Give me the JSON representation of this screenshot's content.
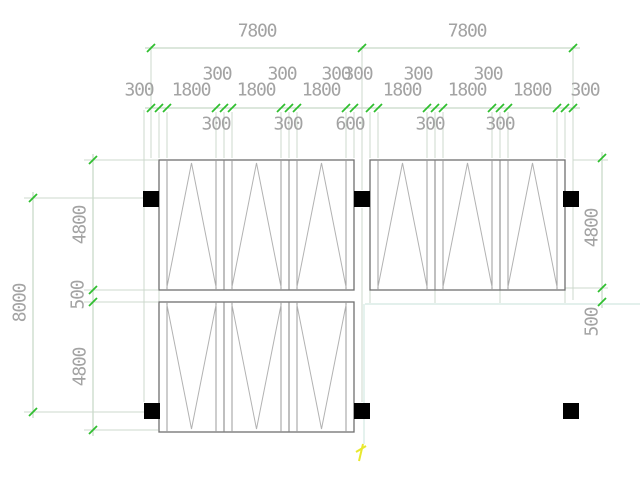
{
  "canvas": {
    "width": 640,
    "height": 480,
    "background": "#ffffff"
  },
  "palette": {
    "dim_line": "#b9cfb9",
    "ext_line": "#ccd8cc",
    "tick": "#2fbf2f",
    "text": "#a3a3a3",
    "outline": "#6f6f6f",
    "edge": "#7f7f7f",
    "panel": "#9b9b9b",
    "triangle": "#b2b2b2",
    "column": "#000000",
    "teal": "#daece6",
    "yellow": "#e8e82e"
  },
  "dimension_values": {
    "top_spans": [
      "7800",
      "7800"
    ],
    "chain_segments": [
      "300",
      "300",
      "1800",
      "300",
      "300",
      "1800",
      "300",
      "300",
      "1800",
      "300",
      "600",
      "300",
      "1800",
      "300",
      "300",
      "1800",
      "300",
      "300",
      "1800",
      "300",
      "300"
    ],
    "left_column": [
      "4800",
      "500",
      "4800",
      "8000"
    ],
    "right_column": [
      "4800",
      "500"
    ]
  },
  "texts": [
    {
      "n": "dim-7800-left",
      "v": "7800",
      "x": 257,
      "y": 31
    },
    {
      "n": "dim-7800-right",
      "v": "7800",
      "x": 467,
      "y": 31
    },
    {
      "n": "dim-300-rowA",
      "v": "300",
      "x": 217,
      "y": 74
    },
    {
      "n": "dim-300-rowA",
      "v": "300",
      "x": 282,
      "y": 74
    },
    {
      "n": "dim-300-rowA",
      "v": "300",
      "x": 336,
      "y": 74
    },
    {
      "n": "dim-300-rowA",
      "v": "300",
      "x": 358,
      "y": 74
    },
    {
      "n": "dim-300-rowA",
      "v": "300",
      "x": 418,
      "y": 74
    },
    {
      "n": "dim-300-rowA",
      "v": "300",
      "x": 488,
      "y": 74
    },
    {
      "n": "dim-300-rowB",
      "v": "300",
      "x": 139,
      "y": 90
    },
    {
      "n": "dim-1800",
      "v": "1800",
      "x": 191,
      "y": 90
    },
    {
      "n": "dim-1800",
      "v": "1800",
      "x": 256,
      "y": 90
    },
    {
      "n": "dim-1800",
      "v": "1800",
      "x": 321,
      "y": 90
    },
    {
      "n": "dim-1800",
      "v": "1800",
      "x": 402,
      "y": 90
    },
    {
      "n": "dim-1800",
      "v": "1800",
      "x": 467,
      "y": 90
    },
    {
      "n": "dim-1800",
      "v": "1800",
      "x": 532,
      "y": 90
    },
    {
      "n": "dim-300-rowB",
      "v": "300",
      "x": 585,
      "y": 90
    },
    {
      "n": "dim-300-rowC",
      "v": "300",
      "x": 216,
      "y": 124
    },
    {
      "n": "dim-300-rowC",
      "v": "300",
      "x": 288,
      "y": 124
    },
    {
      "n": "dim-600-rowC",
      "v": "600",
      "x": 350,
      "y": 124
    },
    {
      "n": "dim-300-rowC",
      "v": "300",
      "x": 430,
      "y": 124
    },
    {
      "n": "dim-300-rowC",
      "v": "300",
      "x": 500,
      "y": 124
    },
    {
      "n": "dim-4800-left-top",
      "v": "4800",
      "x": 80,
      "y": 225,
      "r": -90
    },
    {
      "n": "dim-500-left",
      "v": "500",
      "x": 78,
      "y": 295,
      "r": -90
    },
    {
      "n": "dim-4800-left-bottom",
      "v": "4800",
      "x": 80,
      "y": 367,
      "r": -90
    },
    {
      "n": "dim-8000-left",
      "v": "8000",
      "x": 20,
      "y": 303,
      "r": -90
    },
    {
      "n": "dim-4800-right",
      "v": "4800",
      "x": 592,
      "y": 228,
      "r": -90
    },
    {
      "n": "dim-500-right",
      "v": "500",
      "x": 592,
      "y": 322,
      "r": -90
    }
  ],
  "chain_x": [
    151,
    159,
    167,
    216,
    224,
    232,
    281,
    289,
    297,
    346,
    354,
    370,
    378,
    427,
    435,
    443,
    492,
    500,
    508,
    557,
    565,
    573
  ],
  "lines": {
    "dim_line": [
      [
        145,
        48,
        580,
        48
      ],
      [
        145,
        108,
        580,
        108
      ],
      [
        33,
        192,
        33,
        418
      ],
      [
        93,
        154,
        93,
        436
      ],
      [
        602,
        152,
        602,
        308
      ]
    ],
    "ext_line": [
      [
        24,
        198,
        143,
        198
      ],
      [
        24,
        412,
        144,
        412
      ],
      [
        84,
        160,
        158,
        160
      ],
      [
        84,
        290,
        158,
        290
      ],
      [
        84,
        302,
        158,
        302
      ],
      [
        84,
        430,
        158,
        430
      ],
      [
        573,
        160,
        608,
        160
      ],
      [
        565,
        288,
        608,
        288
      ],
      [
        151,
        46,
        151,
        158
      ],
      [
        362,
        46,
        362,
        190
      ],
      [
        362,
        208,
        362,
        402
      ],
      [
        573,
        46,
        573,
        300
      ],
      [
        144,
        110,
        144,
        402
      ],
      [
        370,
        290,
        370,
        303
      ],
      [
        435,
        290,
        435,
        303
      ],
      [
        500,
        290,
        500,
        303
      ],
      [
        565,
        290,
        565,
        303
      ],
      [
        159,
        290,
        159,
        302
      ]
    ],
    "teal": [
      [
        365,
        304,
        640,
        304
      ],
      [
        364,
        304,
        364,
        444
      ]
    ],
    "yellow": [
      [
        359,
        461,
        363,
        444
      ],
      [
        356,
        452,
        366,
        446
      ]
    ]
  },
  "blocks": {
    "w": 195,
    "h": 130,
    "panel_w": 65,
    "inset": 8,
    "items": [
      {
        "n": "formwork-block-top-left",
        "x": 159,
        "y": 160,
        "apex": "top"
      },
      {
        "n": "formwork-block-top-right",
        "x": 370,
        "y": 160,
        "apex": "top"
      },
      {
        "n": "formwork-block-bottom-left",
        "x": 159,
        "y": 302,
        "apex": "bottom"
      }
    ]
  },
  "columns": {
    "size": 16,
    "centers": [
      [
        151,
        199
      ],
      [
        362,
        199
      ],
      [
        571,
        199
      ],
      [
        152,
        411
      ],
      [
        362,
        411
      ],
      [
        571,
        411
      ]
    ]
  },
  "ticks": {
    "h": [
      {
        "y": 48,
        "xs": [
          151,
          362,
          573
        ]
      },
      {
        "y": 108,
        "xs": "chain"
      }
    ],
    "v": [
      {
        "x": 33,
        "ys": [
          198,
          412
        ]
      },
      {
        "x": 93,
        "ys": [
          160,
          290,
          302,
          430
        ]
      },
      {
        "x": 602,
        "ys": [
          158,
          288,
          302
        ]
      }
    ]
  }
}
